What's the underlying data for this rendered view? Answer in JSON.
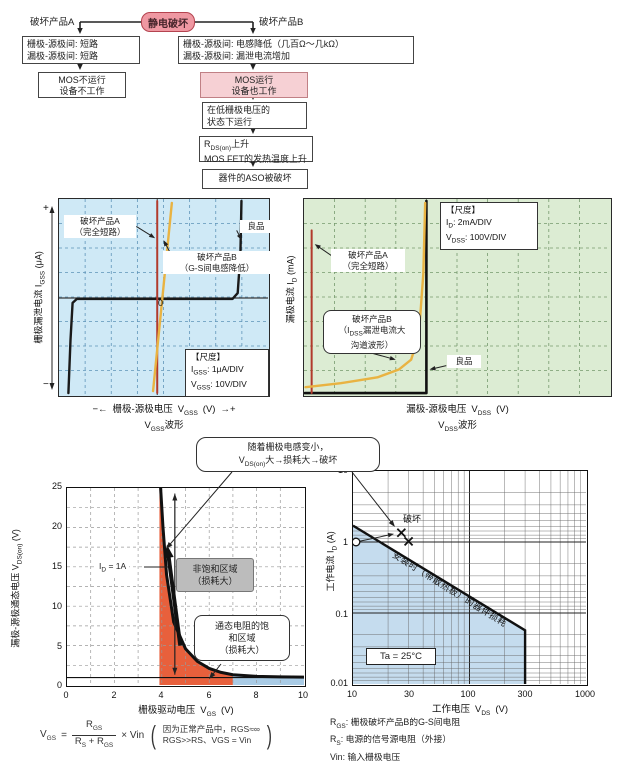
{
  "flowchart": {
    "esd": "静电破坏",
    "label_a": "破坏产品A",
    "label_b": "破坏产品B",
    "a1_l1": "栅极-源极间: 短路",
    "a1_l2": "漏极-源极间: 短路",
    "a2_l1": "MOS不运行",
    "a2_l2": "设备不工作",
    "b1_l1": "栅极-源极间: 电感降低（几百Ω～几kΩ）",
    "b1_l2": "漏极-源极间: 漏泄电流增加",
    "b2_l1": "MOS运行",
    "b2_l2": "设备也工作",
    "b3_l1": "在低栅极电压的",
    "b3_l2": "状态下运行",
    "b4_sym": "R",
    "b4_sub": "DS(on)",
    "b4_rest": "上升",
    "b4_l2": "MOS FET的发热温度上升",
    "b5": "器件的ASO被破坏"
  },
  "gss": {
    "label_a_l1": "破坏产品A",
    "label_a_l2": "（完全短路）",
    "label_b_l1": "破坏产品B",
    "label_b_l2": "（G-S间电感降低）",
    "label_good": "良品",
    "zero": "0",
    "plus": "+",
    "minus": "−",
    "scale_title": "【尺度】",
    "scale1_sym": "I",
    "scale1_sub": "GSS",
    "scale1_rest": ": 1μA/DIV",
    "scale2_sym": "V",
    "scale2_sub": "GSS",
    "scale2_rest": ": 10V/DIV",
    "y_text": "栅极漏泄电流",
    "y_sym": "I",
    "y_sub": "GSS",
    "y_unit": "(μA)",
    "x_left": "−←",
    "x_text": "栅极-源极电压",
    "x_sym": "V",
    "x_sub": "GSS",
    "x_unit": "(V)",
    "x_right": "→+",
    "wave_sym": "V",
    "wave_sub": "GSS",
    "wave_rest": "波形",
    "render": {
      "cols": 8,
      "rows": 8,
      "grid": "#5f94b8",
      "center": {
        "x": 47,
        "y": 50.5
      },
      "traces": [
        {
          "color": "#1a1a1a",
          "w": 2.4,
          "pts": [
            [
              4.5,
              99
            ],
            [
              5.5,
              72
            ],
            [
              6.5,
              53
            ],
            [
              8.5,
              51
            ],
            [
              83,
              51
            ],
            [
              85.5,
              48
            ],
            [
              86.8,
              28
            ],
            [
              87.3,
              1
            ]
          ]
        },
        {
          "color": "#b23a2c",
          "w": 2,
          "pts": [
            [
              47,
              1
            ],
            [
              47,
              99
            ]
          ]
        },
        {
          "color": "#e9b342",
          "w": 2.4,
          "pts": [
            [
              54,
              2
            ],
            [
              45,
              98
            ]
          ]
        }
      ],
      "pointers": [
        [
          37,
          14,
          46,
          20
        ],
        [
          53,
          27,
          50,
          21
        ],
        [
          85,
          16,
          87.4,
          21
        ]
      ]
    }
  },
  "dss": {
    "scale_title": "【尺度】",
    "scale1_sym": "I",
    "scale1_sub": "D",
    "scale1_rest": ": 2mA/DIV",
    "scale2_sym": "V",
    "scale2_sub": "DSS",
    "scale2_rest": ": 100V/DIV",
    "label_a_l1": "破坏产品A",
    "label_a_l2": "（完全短路）",
    "label_b_l1": "破坏产品B",
    "label_b_l2_pre": "（I",
    "label_b_l2_sub": "DSS",
    "label_b_l2_rest": "漏泄电流大",
    "label_b_l3": "沟道波形）",
    "label_good": "良品",
    "y_text": "漏极电流",
    "y_sym": "I",
    "y_sub": "D",
    "y_unit": "(mA)",
    "x_text": "漏极-源极电压",
    "x_sym": "V",
    "x_sub": "DSS",
    "x_unit": "(V)",
    "wave_sym": "V",
    "wave_sub": "DSS",
    "wave_rest": "波形",
    "render": {
      "cols": 10,
      "rows": 8,
      "grid": "#76996e",
      "traces": [
        {
          "color": "#111111",
          "w": 2.6,
          "pts": [
            [
              0.3,
              99
            ],
            [
              40,
              99
            ],
            [
              40,
              1
            ]
          ]
        },
        {
          "color": "#b23a2c",
          "w": 2,
          "pts": [
            [
              2.5,
              16
            ],
            [
              2.5,
              99
            ]
          ]
        },
        {
          "color": "#e9b342",
          "w": 2.4,
          "pts": [
            [
              0.5,
              96
            ],
            [
              12,
              94
            ],
            [
              24,
              91
            ],
            [
              31,
              87
            ],
            [
              35,
              82
            ],
            [
              37.5,
              70
            ],
            [
              39,
              38
            ],
            [
              39.6,
              2
            ]
          ]
        }
      ],
      "pointers": [
        [
          10,
          30,
          3.5,
          23
        ],
        [
          16,
          76,
          30,
          82
        ],
        [
          46.5,
          85,
          41,
          87
        ]
      ]
    }
  },
  "callout": {
    "l1": "随着栅极电感变小，",
    "l2_sym": "V",
    "l2_sub": "DS(on)",
    "l2_rest": "大→损耗大→破坏"
  },
  "bl": {
    "x_ticks": [
      "0",
      "2",
      "4",
      "6",
      "8",
      "10"
    ],
    "y_ticks": [
      "25",
      "20",
      "15",
      "10",
      "5",
      "0"
    ],
    "x_text": "栅极驱动电压",
    "x_sym": "V",
    "x_sub": "GS",
    "x_unit": "(V)",
    "y_text": "漏极-源极通态电压",
    "y_sym": "V",
    "y_sub": "DS(on)",
    "y_unit": "(V)",
    "id_sym": "I",
    "id_sub": "D",
    "id_rest": " = 1A",
    "gray_l1": "非饱和区域",
    "gray_l2": "（损耗大）",
    "sat_l1": "通态电阻的饱",
    "sat_l2": "和区域",
    "sat_l3": "（损耗大）",
    "formula": {
      "sym1": "V",
      "sub1": "GS",
      "eq": "=",
      "num_sym": "R",
      "num_sub": "GS",
      "den1": "R",
      "den_sub1": "S",
      "den2": " + R",
      "den_sub2": "GS",
      "mult": "× Vin",
      "paren_l": "(",
      "paren_r": ")",
      "note1": "因为正常产品中，RGS≈∞",
      "note2": "RGS>>RS、VGS = Vin"
    },
    "render": {
      "red_fill": "#e8603c",
      "blue_fill": "#a9cbe5",
      "red_pts": [
        [
          3.9,
          0
        ],
        [
          3.9,
          24.9
        ],
        [
          4.05,
          20
        ],
        [
          4.2,
          14
        ],
        [
          4.5,
          8
        ],
        [
          5,
          4.6
        ],
        [
          5.5,
          3
        ],
        [
          6,
          2.1
        ],
        [
          6.5,
          1.6
        ],
        [
          7,
          1.3
        ],
        [
          7,
          0
        ]
      ],
      "blue_pts": [
        [
          7,
          0
        ],
        [
          7,
          1.3
        ],
        [
          8,
          1.1
        ],
        [
          10,
          1.02
        ],
        [
          10,
          0
        ]
      ],
      "curve": [
        [
          3.95,
          25
        ],
        [
          4.05,
          20
        ],
        [
          4.2,
          14
        ],
        [
          4.5,
          8
        ],
        [
          5,
          4.6
        ],
        [
          5.5,
          3
        ],
        [
          6,
          2.1
        ],
        [
          6.5,
          1.6
        ],
        [
          7,
          1.3
        ],
        [
          8,
          1.1
        ],
        [
          9,
          1.03
        ],
        [
          10,
          1.0
        ]
      ],
      "hline_y": 0.95,
      "varrow": [
        4.55,
        1.3,
        24.3
      ],
      "tarrow": [
        4.78,
        5.0,
        4.22,
        17.8
      ]
    }
  },
  "soa": {
    "x_ticks": [
      "10",
      "30",
      "100",
      "300",
      "1000"
    ],
    "y_ticks": [
      "10",
      "1",
      "0.1",
      "0.01"
    ],
    "x_text": "工作电压",
    "x_sym": "V",
    "x_sub": "DS",
    "x_unit": "(V)",
    "y_text": "工作电流",
    "y_sym": "I",
    "y_sub": "D",
    "y_unit": "(A)",
    "broken": "破坏",
    "diag": "安装时（带散热板）的器件损耗",
    "ta": "Ta = 25°C",
    "legend": [
      {
        "sym": "R",
        "sub": "GS",
        "rest": ": 栅极破坏产品B的G-S间电阻"
      },
      {
        "sym": "R",
        "sub": "S",
        "rest": ": 电源的信号源电阻（外接）"
      },
      {
        "sym": "Vin",
        "sub": "",
        "rest": ": 输入栅极电压"
      }
    ],
    "render": {
      "region_color": "#c5dcee",
      "region": [
        [
          10,
          1.7
        ],
        [
          300,
          0.057
        ],
        [
          300,
          0.01
        ],
        [
          10,
          0.01
        ]
      ],
      "boundary": [
        [
          10,
          1.7
        ],
        [
          300,
          0.057
        ],
        [
          300,
          0.01
        ]
      ],
      "circle": [
        10,
        1
      ],
      "cross": [
        [
          26,
          1.35
        ],
        [
          30,
          1.02
        ]
      ],
      "arrow": [
        11.5,
        1.03,
        22.5,
        1.3
      ]
    }
  },
  "overlay": {
    "back_lines": [
      [
        80,
        22,
        253,
        22
      ]
    ],
    "back_arrows": [
      [
        80,
        22,
        80,
        34
      ],
      [
        253,
        22,
        253,
        34
      ],
      [
        80,
        63,
        80,
        70
      ],
      [
        253,
        63,
        253,
        70
      ],
      [
        253,
        97,
        253,
        100
      ],
      [
        253,
        128,
        253,
        134
      ],
      [
        253,
        161,
        253,
        167
      ]
    ],
    "front_arrows": [
      [
        232,
        472,
        166,
        549
      ],
      [
        352,
        472,
        395,
        527
      ],
      [
        52,
        299,
        52,
        206
      ],
      [
        52,
        299,
        52,
        390
      ],
      [
        221,
        664,
        209,
        679
      ]
    ],
    "front_lines": [
      [
        144,
        567,
        168,
        567
      ]
    ]
  },
  "chart_data": [
    {
      "type": "line",
      "title": "VGSS波形",
      "xlabel": "栅极-源极电压 VGSS (V)",
      "ylabel": "栅极漏泄电流 IGSS (μA)",
      "scale": {
        "IGSS": "1μA/DIV",
        "VGSS": "10V/DIV"
      },
      "grid": "8x8 DIV",
      "series": [
        "良品",
        "破坏产品A（完全短路）",
        "破坏产品B（G-S间电感降低）"
      ]
    },
    {
      "type": "line",
      "title": "VDSS波形",
      "xlabel": "漏极-源极电压 VDSS (V)",
      "ylabel": "漏极电流 ID (mA)",
      "scale": {
        "ID": "2mA/DIV",
        "VDSS": "100V/DIV"
      },
      "grid": "10x8 DIV",
      "series": [
        "良品",
        "破坏产品A（完全短路）",
        "破坏产品B（ID SS漏泄电流大 沟道波形）"
      ]
    },
    {
      "type": "line",
      "xlabel": "栅极驱动电压 VGS (V)",
      "ylabel": "漏极-源极通态电压 VDS(on) (V)",
      "xlim": [
        0,
        10
      ],
      "ylim": [
        0,
        25
      ],
      "condition": "ID = 1A",
      "curve_points": [
        [
          4,
          25
        ],
        [
          4.2,
          14
        ],
        [
          4.5,
          8
        ],
        [
          5,
          4.6
        ],
        [
          5.5,
          3
        ],
        [
          6,
          2.1
        ],
        [
          6.5,
          1.6
        ],
        [
          7,
          1.3
        ],
        [
          8,
          1.1
        ],
        [
          10,
          1
        ]
      ],
      "regions": [
        "非饱和区域（损耗大）x≈4-7",
        "通态电阻的饱和区域（损耗大）x≈7-10"
      ]
    },
    {
      "type": "line",
      "xlabel": "工作电压 VDS (V)",
      "ylabel": "工作电流 ID (A)",
      "xlim": [
        10,
        1000
      ],
      "ylim": [
        0.01,
        10
      ],
      "scale": "log-log",
      "condition": "Ta = 25°C",
      "boundary_label": "安装时（带散热板）的器件损耗",
      "boundary_points": [
        [
          10,
          1.7
        ],
        [
          300,
          0.057
        ],
        [
          300,
          0.01
        ]
      ],
      "markers": {
        "circle": [
          10,
          1
        ],
        "cross": [
          [
            26,
            1.35
          ],
          [
            30,
            1.02
          ]
        ],
        "cross_label": "破坏"
      }
    }
  ]
}
